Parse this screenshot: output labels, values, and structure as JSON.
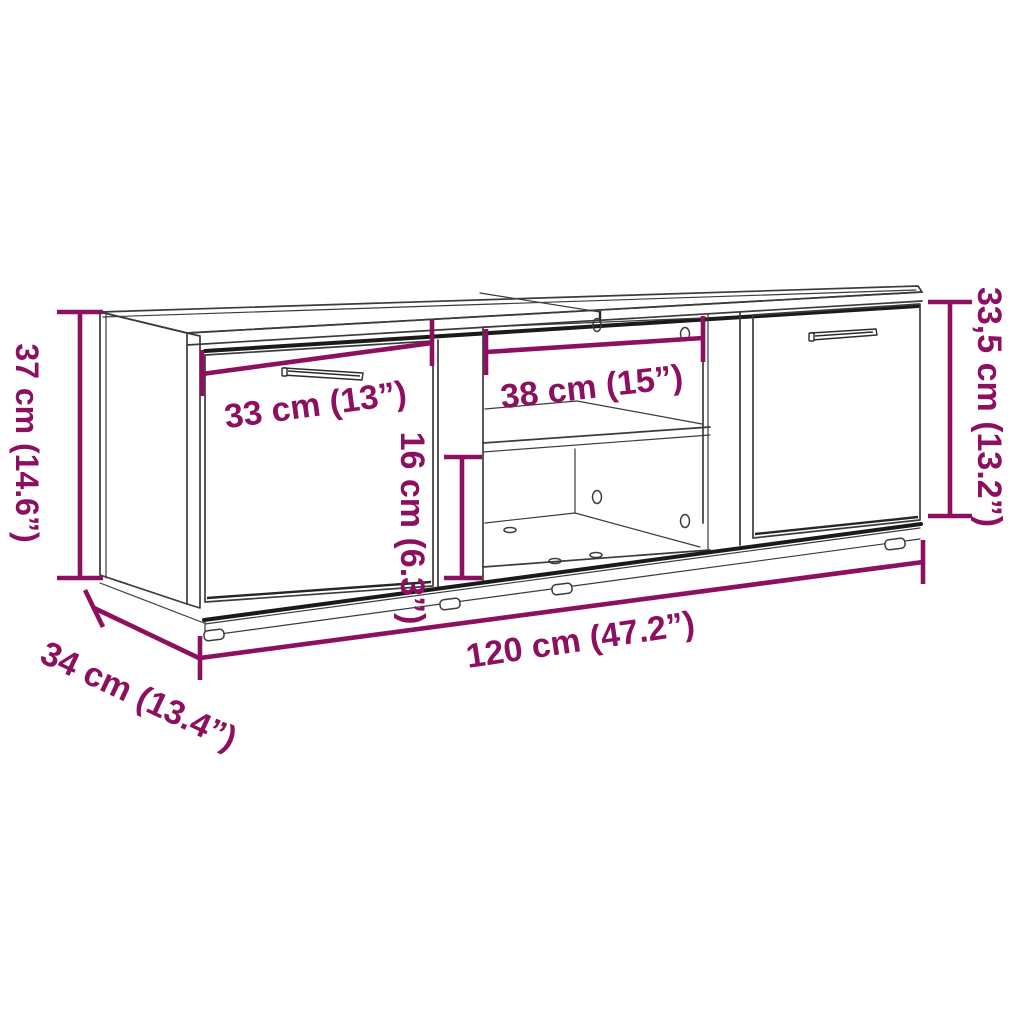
{
  "title": "Cabinet dimension diagram",
  "colors": {
    "accent": "#8D1060",
    "line": "#3B3B3B",
    "background": "#FFFFFF"
  },
  "dimensions": {
    "side_height": {
      "label": "37 cm (14.6”)"
    },
    "left_door_width": {
      "label": "33 cm (13”)"
    },
    "shelf_width": {
      "label": "38 cm (15”)"
    },
    "lower_compartment_height": {
      "label": "16 cm (6.3”)"
    },
    "door_height": {
      "label": "33,5 cm (13.2”)"
    },
    "total_width": {
      "label": "120 cm (47.2”)"
    },
    "depth": {
      "label": "34 cm (13.4”)"
    }
  }
}
